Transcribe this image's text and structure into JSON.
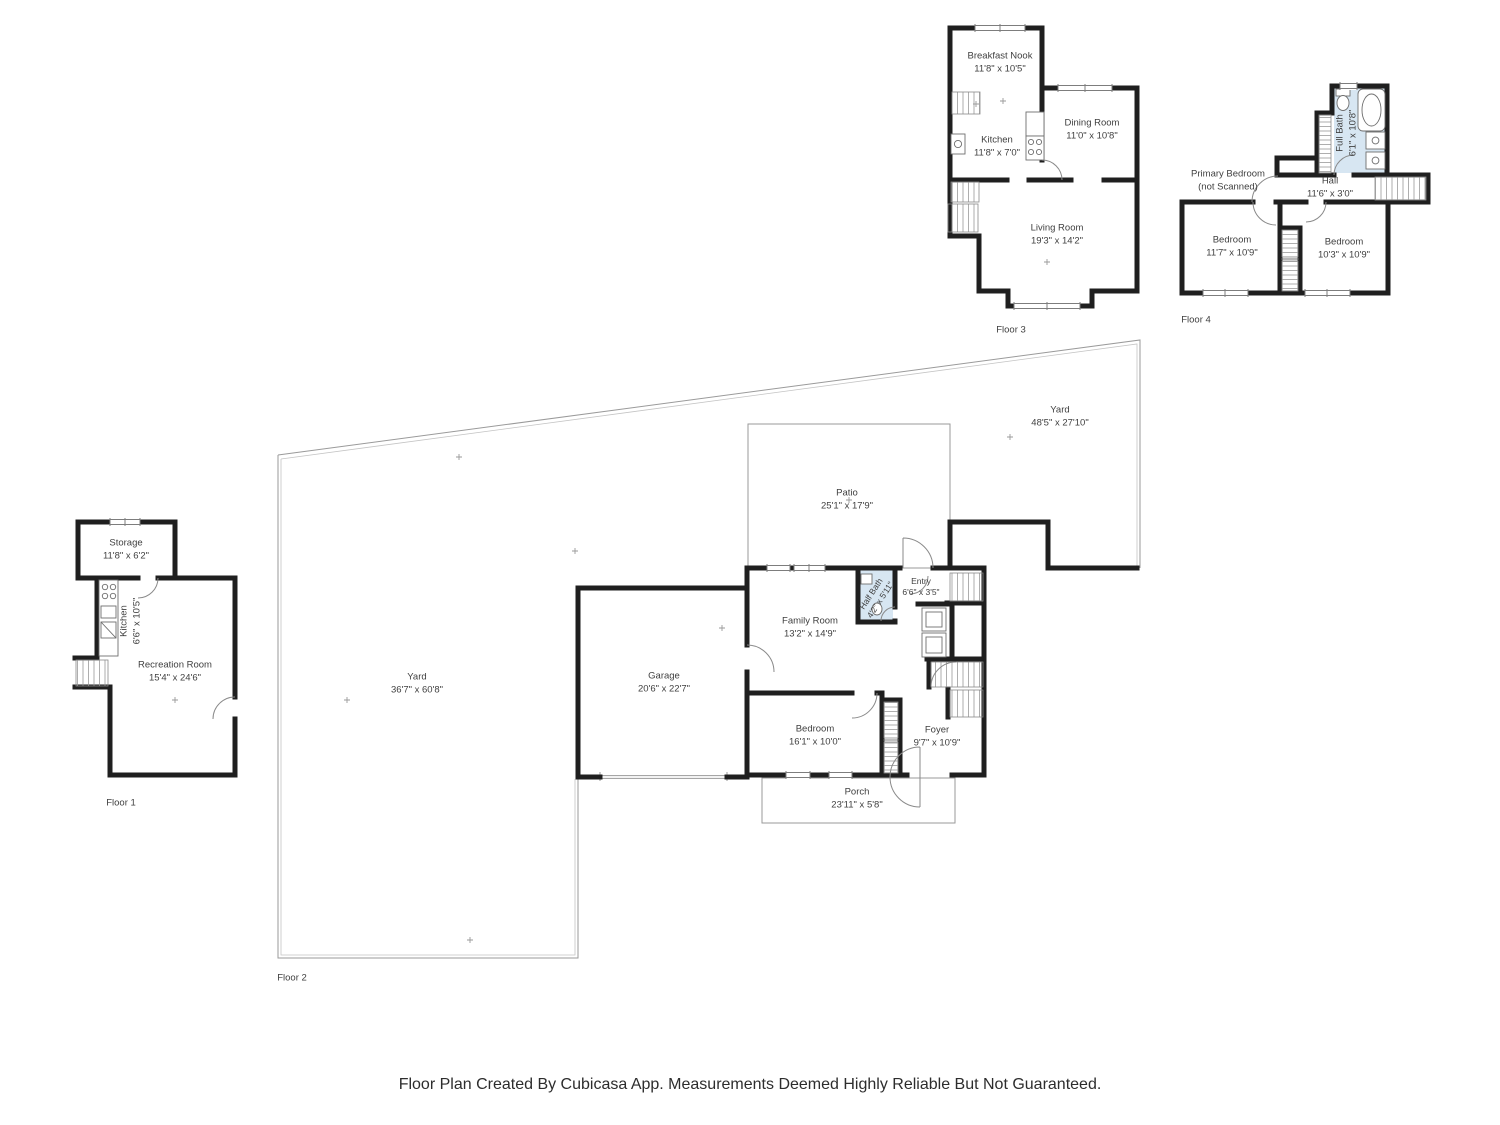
{
  "caption": "Floor Plan Created By Cubicasa App. Measurements Deemed Highly Reliable But Not Guaranteed.",
  "colors": {
    "wall": "#1f1f1f",
    "bath_fill": "#d7e6f2",
    "thin_line": "#9a9a9a",
    "label_text": "#3f3f3f"
  },
  "floor1": {
    "label": "Floor 1",
    "storage": {
      "name": "Storage",
      "dims": "11'8\" x 6'2\""
    },
    "kitchen": {
      "name": "Kitchen",
      "dims": "6'6\" x 10'5\""
    },
    "recreation": {
      "name": "Recreation Room",
      "dims": "15'4\" x 24'6\""
    }
  },
  "floor2": {
    "label": "Floor 2",
    "yard_left": {
      "name": "Yard",
      "dims": "36'7\" x 60'8\""
    },
    "yard_right": {
      "name": "Yard",
      "dims": "48'5\" x 27'10\""
    },
    "patio": {
      "name": "Patio",
      "dims": "25'1\" x 17'9\""
    },
    "garage": {
      "name": "Garage",
      "dims": "20'6\" x 22'7\""
    },
    "family_room": {
      "name": "Family Room",
      "dims": "13'2\" x 14'9\""
    },
    "half_bath": {
      "name": "Half Bath",
      "dims": "4'2\" x 5'11\""
    },
    "entry": {
      "name": "Entry",
      "dims": "6'6\" x 3'5\""
    },
    "bedroom": {
      "name": "Bedroom",
      "dims": "16'1\" x 10'0\""
    },
    "foyer": {
      "name": "Foyer",
      "dims": "9'7\" x 10'9\""
    },
    "porch": {
      "name": "Porch",
      "dims": "23'11\" x 5'8\""
    }
  },
  "floor3": {
    "label": "Floor 3",
    "breakfast_nook": {
      "name": "Breakfast Nook",
      "dims": "11'8\" x 10'5\""
    },
    "kitchen": {
      "name": "Kitchen",
      "dims": "11'8\" x 7'0\""
    },
    "dining_room": {
      "name": "Dining Room",
      "dims": "11'0\" x 10'8\""
    },
    "living_room": {
      "name": "Living Room",
      "dims": "19'3\" x 14'2\""
    }
  },
  "floor4": {
    "label": "Floor 4",
    "primary_bedroom": {
      "name": "Primary Bedroom",
      "dims": "(not Scanned)"
    },
    "hall": {
      "name": "Hall",
      "dims": "11'6\" x 3'0\""
    },
    "full_bath": {
      "name": "Full Bath",
      "dims": "6'1\" x 10'8\""
    },
    "bedroom_left": {
      "name": "Bedroom",
      "dims": "11'7\" x 10'9\""
    },
    "bedroom_right": {
      "name": "Bedroom",
      "dims": "10'3\" x 10'9\""
    }
  }
}
